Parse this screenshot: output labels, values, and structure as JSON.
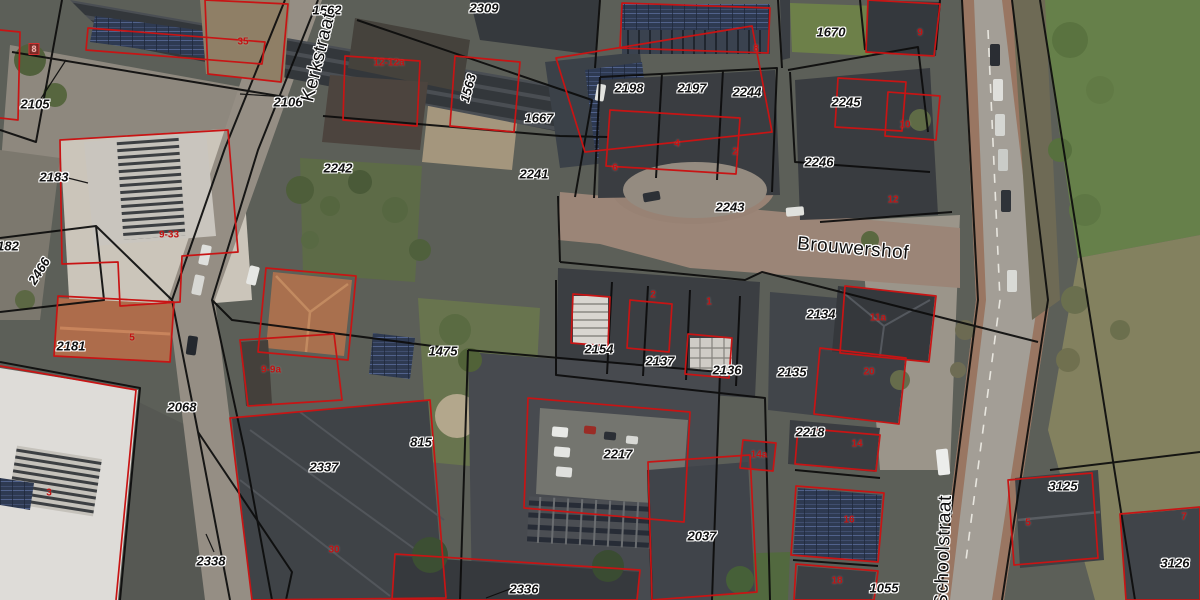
{
  "map": {
    "street_labels": [
      {
        "text": "Kerkstraat",
        "x": 319,
        "y": 57,
        "rotation": -76
      },
      {
        "text": "Brouwershof",
        "x": 853,
        "y": 249,
        "rotation": 5
      },
      {
        "text": "Schoolstraat",
        "x": 944,
        "y": 551,
        "rotation": -88
      }
    ],
    "parcel_labels": [
      {
        "text": "1562",
        "x": 327,
        "y": 10
      },
      {
        "text": "2309",
        "x": 484,
        "y": 8
      },
      {
        "text": "2105",
        "x": 35,
        "y": 104
      },
      {
        "text": "2106",
        "x": 288,
        "y": 102
      },
      {
        "text": "1563",
        "x": 468,
        "y": 88,
        "rotation": -75
      },
      {
        "text": "1667",
        "x": 539,
        "y": 118
      },
      {
        "text": "2198",
        "x": 629,
        "y": 88
      },
      {
        "text": "2197",
        "x": 692,
        "y": 88
      },
      {
        "text": "2244",
        "x": 747,
        "y": 92
      },
      {
        "text": "2245",
        "x": 846,
        "y": 102
      },
      {
        "text": "1670",
        "x": 831,
        "y": 32
      },
      {
        "text": "2242",
        "x": 338,
        "y": 168
      },
      {
        "text": "2241",
        "x": 534,
        "y": 174
      },
      {
        "text": "2243",
        "x": 730,
        "y": 207
      },
      {
        "text": "2246",
        "x": 819,
        "y": 162
      },
      {
        "text": "2183",
        "x": 54,
        "y": 177
      },
      {
        "text": "182",
        "x": 8,
        "y": 246
      },
      {
        "text": "2466",
        "x": 39,
        "y": 271,
        "rotation": -58
      },
      {
        "text": "2181",
        "x": 71,
        "y": 346
      },
      {
        "text": "2134",
        "x": 821,
        "y": 314
      },
      {
        "text": "2135",
        "x": 792,
        "y": 372
      },
      {
        "text": "2136",
        "x": 727,
        "y": 370
      },
      {
        "text": "2137",
        "x": 660,
        "y": 361
      },
      {
        "text": "2154",
        "x": 599,
        "y": 349
      },
      {
        "text": "1475",
        "x": 443,
        "y": 351
      },
      {
        "text": "2068",
        "x": 182,
        "y": 407
      },
      {
        "text": "815",
        "x": 421,
        "y": 442
      },
      {
        "text": "2337",
        "x": 324,
        "y": 467
      },
      {
        "text": "2338",
        "x": 211,
        "y": 561
      },
      {
        "text": "2217",
        "x": 618,
        "y": 454
      },
      {
        "text": "2218",
        "x": 810,
        "y": 432
      },
      {
        "text": "2037",
        "x": 702,
        "y": 536
      },
      {
        "text": "2336",
        "x": 524,
        "y": 589
      },
      {
        "text": "1055",
        "x": 884,
        "y": 588
      },
      {
        "text": "3125",
        "x": 1063,
        "y": 486
      },
      {
        "text": "3126",
        "x": 1175,
        "y": 563
      }
    ],
    "building_numbers": [
      {
        "text": "8",
        "x": 34,
        "y": 49,
        "boxed": true
      },
      {
        "text": "35",
        "x": 243,
        "y": 42
      },
      {
        "text": "12-12a",
        "x": 389,
        "y": 63
      },
      {
        "text": "8",
        "x": 756,
        "y": 49
      },
      {
        "text": "4",
        "x": 677,
        "y": 144
      },
      {
        "text": "2",
        "x": 735,
        "y": 152
      },
      {
        "text": "6",
        "x": 615,
        "y": 168
      },
      {
        "text": "9",
        "x": 920,
        "y": 33
      },
      {
        "text": "10",
        "x": 905,
        "y": 125
      },
      {
        "text": "12",
        "x": 893,
        "y": 200
      },
      {
        "text": "9-33",
        "x": 169,
        "y": 235
      },
      {
        "text": "5",
        "x": 132,
        "y": 338
      },
      {
        "text": "2",
        "x": 653,
        "y": 295
      },
      {
        "text": "1",
        "x": 709,
        "y": 302
      },
      {
        "text": "11a",
        "x": 878,
        "y": 318
      },
      {
        "text": "20",
        "x": 869,
        "y": 372
      },
      {
        "text": "14",
        "x": 857,
        "y": 444
      },
      {
        "text": "14a",
        "x": 759,
        "y": 455
      },
      {
        "text": "16",
        "x": 849,
        "y": 520
      },
      {
        "text": "18",
        "x": 837,
        "y": 581
      },
      {
        "text": "9-9a",
        "x": 271,
        "y": 370
      },
      {
        "text": "3",
        "x": 49,
        "y": 493
      },
      {
        "text": "30",
        "x": 334,
        "y": 550
      },
      {
        "text": "5",
        "x": 1028,
        "y": 523
      },
      {
        "text": "7",
        "x": 1184,
        "y": 517
      }
    ],
    "colors": {
      "parcel_line": "#0c0c0c",
      "building_outline": "#c81414",
      "label_text": "#111111",
      "label_halo": "#ffffff",
      "building_number": "#c21212"
    }
  }
}
